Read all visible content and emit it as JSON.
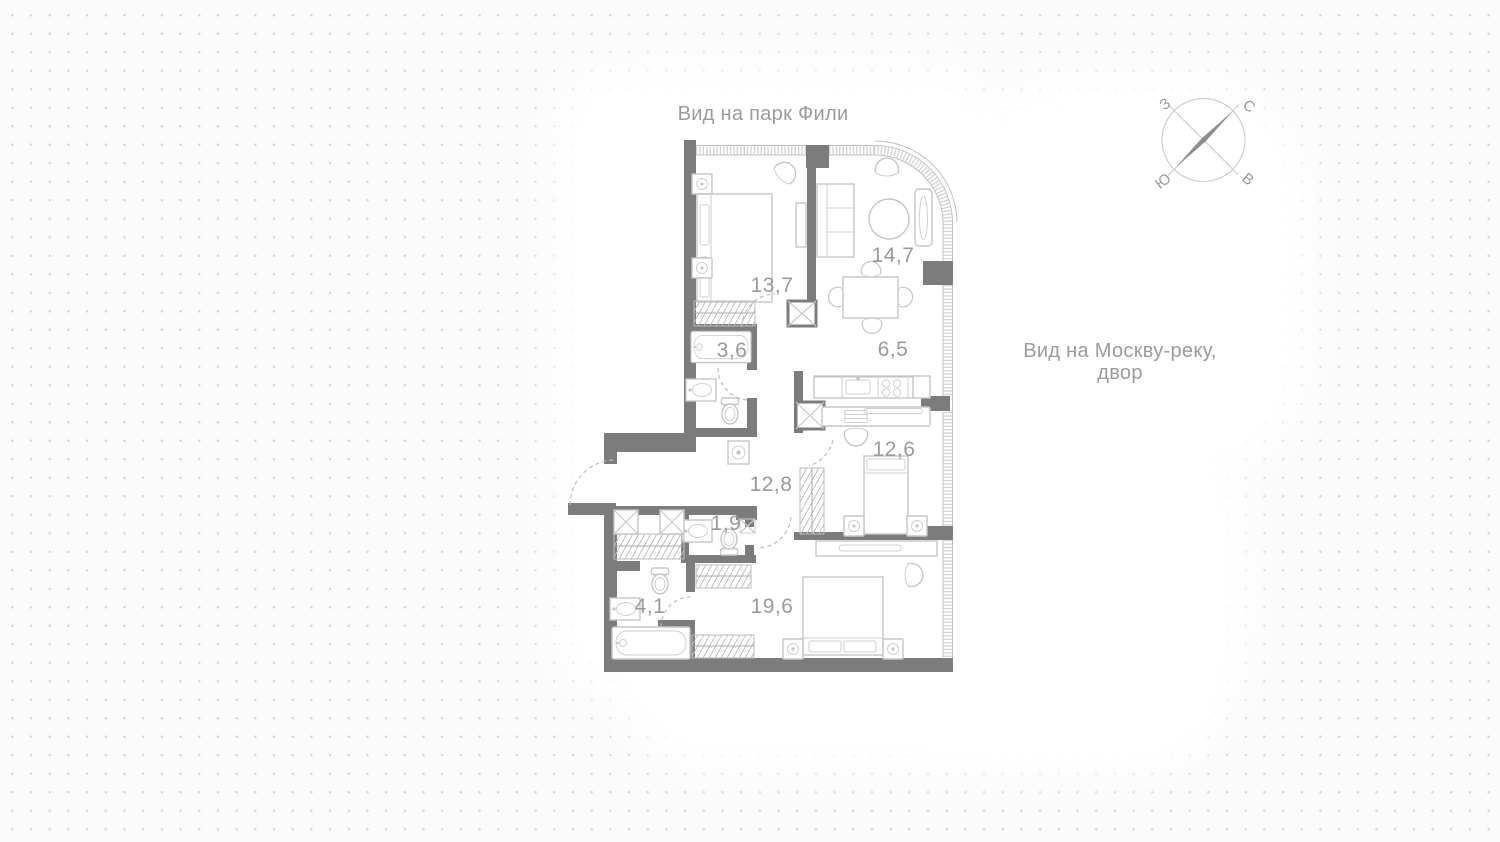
{
  "colors": {
    "wall": "#7c7c7c",
    "furniture_line": "#c6c6c6",
    "label_text": "#9a9a9a",
    "background_dots": "#d6d6d6",
    "window_tick": "#d4d4d4"
  },
  "view_labels": {
    "top": "Вид на парк Фили",
    "right_line1": "Вид на Москву-реку,",
    "right_line2": "двор"
  },
  "compass": {
    "north": "С",
    "south": "Ю",
    "west": "З",
    "east": "В"
  },
  "rooms": [
    {
      "id": "bedroom-1",
      "area": "13,7"
    },
    {
      "id": "living-room",
      "area": "14,7"
    },
    {
      "id": "bathroom-1",
      "area": "3,6"
    },
    {
      "id": "kitchen",
      "area": "6,5"
    },
    {
      "id": "bedroom-2",
      "area": "12,6"
    },
    {
      "id": "hallway",
      "area": "12,8"
    },
    {
      "id": "wc",
      "area": "1,9"
    },
    {
      "id": "bathroom-2",
      "area": "4,1"
    },
    {
      "id": "bedroom-3",
      "area": "19,6"
    }
  ]
}
